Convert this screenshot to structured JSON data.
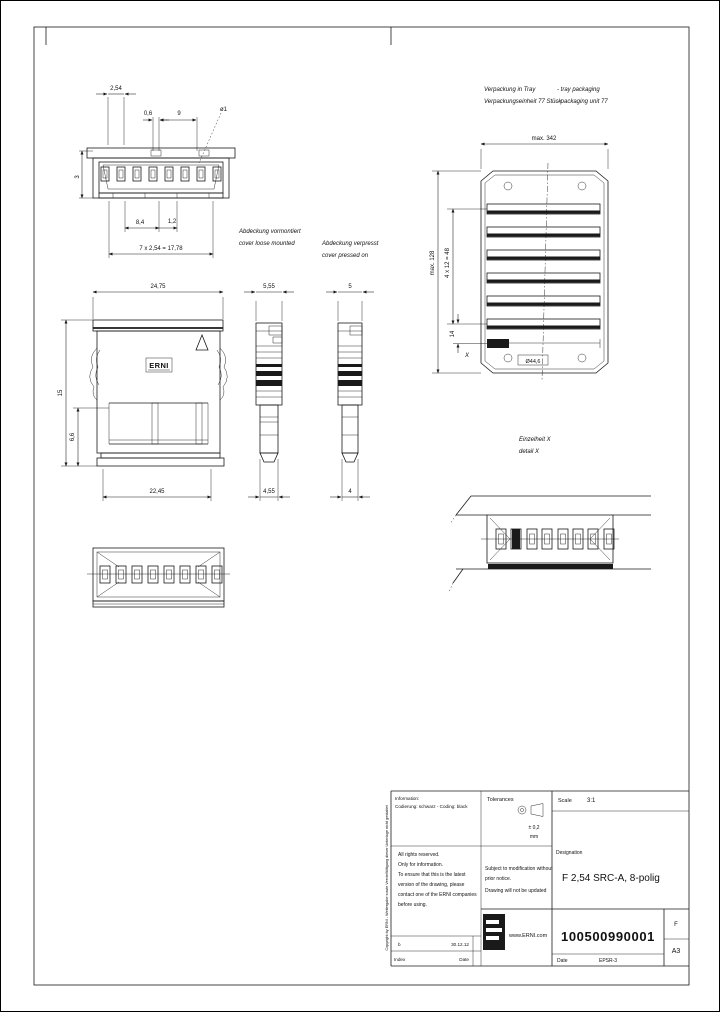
{
  "views": {
    "front_top": {
      "dims": {
        "pitch": "2,54",
        "gap": "0,6",
        "nine": "9",
        "dia": "ø1",
        "three": "3",
        "d84": "8,4",
        "d12": "1,2",
        "total": "7 x 2,54 = 17,78"
      }
    },
    "front_main": {
      "logo": "ERNI",
      "dims": {
        "w_top": "24,75",
        "w_bot": "22,45",
        "h": "15",
        "h2": "6,6"
      }
    },
    "side_loose": {
      "dims": {
        "top": "5,55",
        "bot": "4,55"
      }
    },
    "side_pressed": {
      "dims": {
        "top": "5",
        "bot": "4"
      }
    },
    "notes": {
      "loose_de": "Abdeckung vormontiert",
      "loose_en": "cover loose mounted",
      "pressed_de": "Abdeckung verpresst",
      "pressed_en": "cover pressed on"
    },
    "tray": {
      "title_de": "Verpackung in Tray",
      "title_en": "- tray packaging",
      "unit_de": "Verpackungseinheit 77 Stück",
      "unit_en": "- packaging unit 77",
      "dims": {
        "w": "max. 342",
        "h": "max. 128",
        "rows": "4 x 12 = 48",
        "d14": "14",
        "pocket": "Ø44,6"
      },
      "detail_marker": "X"
    },
    "detail": {
      "label_de": "Einzelheit X",
      "label_en": "detail X"
    }
  },
  "titleblock": {
    "info_line1": "Information:",
    "info_line2": "Codierung: schwarz - Coding: black",
    "rights": [
      "All rights reserved.",
      "Only for information.",
      "To ensure that this is the latest",
      "version of the drawing, please",
      "contact one of the ERNI companies",
      "before using."
    ],
    "tolerances_label": "Tolerances",
    "tolerances_value": "± 0,2",
    "tolerances_unit": "mm",
    "modification": [
      "Subject to modification without",
      "prior notice.",
      "Drawing will not be updated"
    ],
    "scale_label": "Scale",
    "scale_value": "3:1",
    "designation_label": "Designation",
    "designation_value": "F 2,54 SRC-A, 8-polig",
    "website": "www.ERNI.com",
    "part_number": "100500990001",
    "sheet_letter": "F",
    "format": "A3",
    "date_label": "Date",
    "date_value": "EPSR-3",
    "field1_label": "b",
    "field1_value": "30.12.12",
    "field2_label": "Index",
    "field2_value": "Date",
    "copyright": "Copyright by ERNI - Weitergabe sowie Vervielfältigung dieser Unterlage nicht gestattet"
  }
}
